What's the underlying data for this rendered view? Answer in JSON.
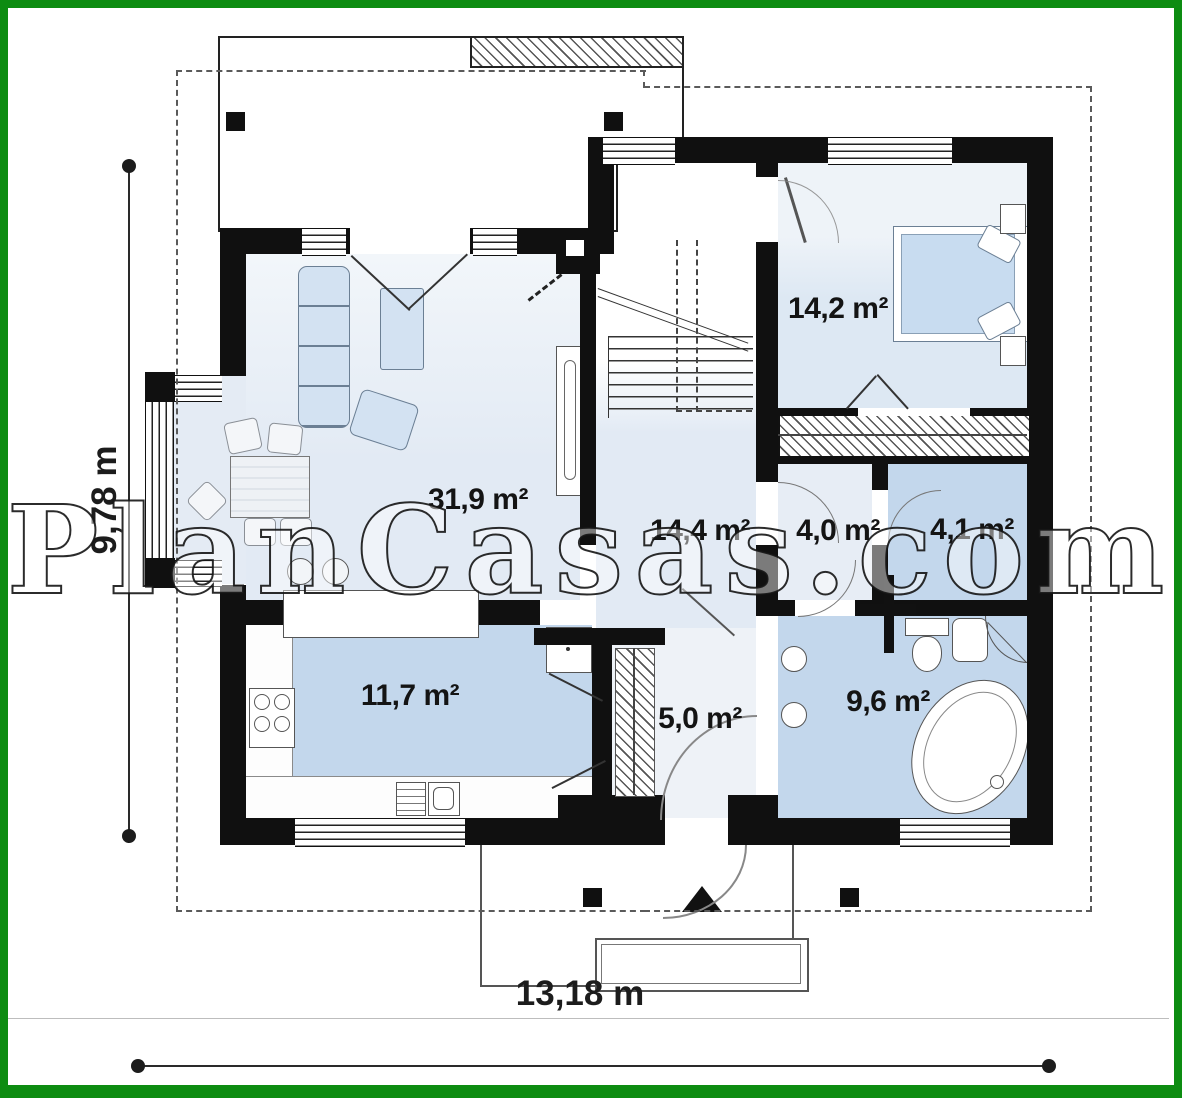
{
  "watermark": "PlanCasas.com",
  "dimensions": {
    "width_label": "13,18 m",
    "height_label": "9,78 m"
  },
  "rooms": {
    "living": {
      "area": "31,9 m²"
    },
    "bedroom": {
      "area": "14,2 m²"
    },
    "hall": {
      "area": "14,4 m²"
    },
    "closet": {
      "area": "4,0 m²"
    },
    "storage": {
      "area": "4,1 m²"
    },
    "kitchen": {
      "area": "11,7 m²"
    },
    "entry": {
      "area": "5,0 m²"
    },
    "bathroom": {
      "area": "9,6 m²"
    }
  },
  "colors": {
    "frame_green": "#0d8c11",
    "wall_black": "#101010",
    "room_light": "#e6edf5",
    "room_medium": "#c3d7ec",
    "furniture_blue": "#d3e2f2"
  }
}
